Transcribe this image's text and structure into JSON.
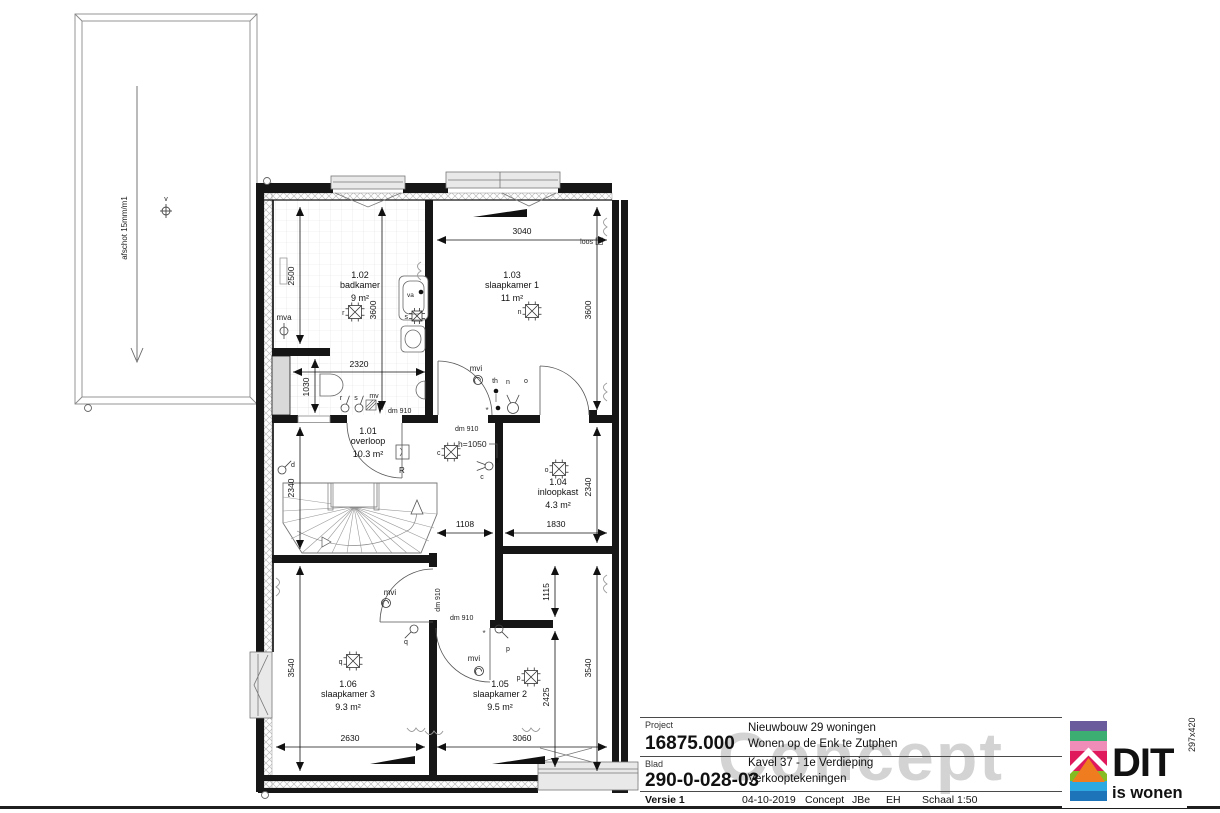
{
  "sheet": {
    "watermark": "Concept",
    "paper_size": "297x420"
  },
  "title_block": {
    "project_label": "Project",
    "project_number": "16875.000",
    "project_line1": "Nieuwbouw 29 woningen",
    "project_line2": "Wonen op de Enk te Zutphen",
    "blad_label": "Blad",
    "blad_number": "290-0-028-03",
    "blad_line1": "Kavel 37 - 1e Verdieping",
    "blad_line2": "Verkooptekeningen",
    "versie": "Versie 1",
    "date": "04-10-2019",
    "status": "Concept",
    "drawn_by": "JBe",
    "checked_by": "EH",
    "scale": "Schaal 1:50"
  },
  "logo": {
    "text_main": "DIT",
    "text_sub": "is wonen",
    "stripes": [
      "#6a5b9d",
      "#3cae71",
      "#f08cb8",
      "#e0195d",
      "#e0195d",
      "#85bc22",
      "#2ba9e0",
      "#1e74b8"
    ],
    "house_fill": "#ef7d1f"
  },
  "plan": {
    "rooms": [
      {
        "num": "1.02",
        "name": "badkamer",
        "area": "9 m²",
        "x": 360,
        "y": 278
      },
      {
        "num": "1.03",
        "name": "slaapkamer 1",
        "area": "11 m²",
        "x": 512,
        "y": 278
      },
      {
        "num": "1.01",
        "name": "overloop",
        "area": "10.3 m²",
        "x": 368,
        "y": 434
      },
      {
        "num": "1.04",
        "name": "inloopkast",
        "area": "4.3 m²",
        "x": 558,
        "y": 485
      },
      {
        "num": "1.06",
        "name": "slaapkamer 3",
        "area": "9.3 m²",
        "x": 348,
        "y": 687
      },
      {
        "num": "1.05",
        "name": "slaapkamer 2",
        "area": "9.5 m²",
        "x": 500,
        "y": 687
      }
    ],
    "dims": [
      {
        "x1": 300,
        "y1": 207,
        "x2": 300,
        "y2": 344,
        "t": "2500",
        "tx": 294,
        "ty": 276,
        "r": -90
      },
      {
        "x1": 382,
        "y1": 207,
        "x2": 382,
        "y2": 410,
        "t": "3600",
        "tx": 376,
        "ty": 310,
        "r": -90
      },
      {
        "x1": 315,
        "y1": 359,
        "x2": 315,
        "y2": 413,
        "t": "1030",
        "tx": 309,
        "ty": 387,
        "r": -90
      },
      {
        "x1": 300,
        "y1": 427,
        "x2": 300,
        "y2": 549,
        "t": "2340",
        "tx": 294,
        "ty": 488,
        "r": -90
      },
      {
        "x1": 300,
        "y1": 566,
        "x2": 300,
        "y2": 771,
        "t": "3540",
        "tx": 294,
        "ty": 668,
        "r": -90
      },
      {
        "x1": 597,
        "y1": 207,
        "x2": 597,
        "y2": 410,
        "t": "3600",
        "tx": 591,
        "ty": 310,
        "r": -90
      },
      {
        "x1": 597,
        "y1": 427,
        "x2": 597,
        "y2": 543,
        "t": "2340",
        "tx": 591,
        "ty": 487,
        "r": -90
      },
      {
        "x1": 555,
        "y1": 566,
        "x2": 555,
        "y2": 617,
        "t": "1115",
        "tx": 549,
        "ty": 592,
        "r": -90
      },
      {
        "x1": 597,
        "y1": 566,
        "x2": 597,
        "y2": 771,
        "t": "3540",
        "tx": 591,
        "ty": 668,
        "r": -90
      },
      {
        "x1": 555,
        "y1": 631,
        "x2": 555,
        "y2": 767,
        "t": "2425",
        "tx": 549,
        "ty": 697,
        "r": -90
      },
      {
        "x1": 293,
        "y1": 372,
        "x2": 425,
        "y2": 372,
        "t": "2320",
        "tx": 359,
        "ty": 367,
        "r": 0
      },
      {
        "x1": 437,
        "y1": 240,
        "x2": 607,
        "y2": 240,
        "t": "3040",
        "tx": 522,
        "ty": 234,
        "r": 0
      },
      {
        "x1": 437,
        "y1": 533,
        "x2": 493,
        "y2": 533,
        "t": "1108",
        "tx": 465,
        "ty": 527,
        "r": 0
      },
      {
        "x1": 505,
        "y1": 533,
        "x2": 607,
        "y2": 533,
        "t": "1830",
        "tx": 556,
        "ty": 527,
        "r": 0
      },
      {
        "x1": 276,
        "y1": 747,
        "x2": 425,
        "y2": 747,
        "t": "2630",
        "tx": 350,
        "ty": 741,
        "r": 0
      },
      {
        "x1": 437,
        "y1": 747,
        "x2": 607,
        "y2": 747,
        "t": "3060",
        "tx": 522,
        "ty": 741,
        "r": 0
      }
    ],
    "annots": [
      {
        "t": "mva",
        "x": 284,
        "y": 320,
        "fs": 8,
        "a": "middle"
      },
      {
        "t": "loos",
        "x": 593,
        "y": 244,
        "fs": 7,
        "a": "end"
      },
      {
        "t": "mvi",
        "x": 476,
        "y": 371,
        "fs": 8,
        "a": "middle"
      },
      {
        "t": "mvi",
        "x": 390,
        "y": 595,
        "fs": 8,
        "a": "middle"
      },
      {
        "t": "mvi",
        "x": 474,
        "y": 661,
        "fs": 8,
        "a": "middle"
      },
      {
        "t": "dm 910",
        "x": 388,
        "y": 413,
        "fs": 7,
        "a": "start"
      },
      {
        "t": "dm 910",
        "x": 455,
        "y": 431,
        "fs": 7,
        "a": "start"
      },
      {
        "t": "dm 910",
        "x": 450,
        "y": 620,
        "fs": 7,
        "a": "start"
      },
      {
        "t": "dm 910",
        "x": 440,
        "y": 600,
        "fs": 7,
        "a": "middle",
        "r": -90
      },
      {
        "t": "h=1050",
        "x": 458,
        "y": 447,
        "fs": 8.5,
        "a": "start"
      },
      {
        "t": "R",
        "x": 399,
        "y": 473,
        "fs": 8,
        "a": "start"
      },
      {
        "t": "va",
        "x": 407,
        "y": 297,
        "fs": 6.5,
        "a": "start"
      },
      {
        "t": "v",
        "x": 166,
        "y": 201,
        "fs": 7,
        "a": "middle"
      },
      {
        "t": "afschot 15mm/m1",
        "x": 127,
        "y": 228,
        "fs": 8,
        "a": "middle",
        "r": -90
      },
      {
        "t": "r",
        "x": 341,
        "y": 400,
        "fs": 7,
        "a": "middle"
      },
      {
        "t": "s",
        "x": 356,
        "y": 400,
        "fs": 7,
        "a": "middle"
      },
      {
        "t": "mv",
        "x": 374,
        "y": 398,
        "fs": 7,
        "a": "middle"
      },
      {
        "t": "th",
        "x": 495,
        "y": 383,
        "fs": 7,
        "a": "middle"
      },
      {
        "t": "n",
        "x": 508,
        "y": 384,
        "fs": 7,
        "a": "middle"
      },
      {
        "t": "o",
        "x": 526,
        "y": 383,
        "fs": 7,
        "a": "middle"
      },
      {
        "t": "d",
        "x": 293,
        "y": 467,
        "fs": 7,
        "a": "middle"
      },
      {
        "t": "q",
        "x": 406,
        "y": 644,
        "fs": 7,
        "a": "middle"
      },
      {
        "t": "p",
        "x": 508,
        "y": 651,
        "fs": 7,
        "a": "middle"
      },
      {
        "t": "c",
        "x": 482,
        "y": 479,
        "fs": 7,
        "a": "middle"
      }
    ],
    "lights": [
      {
        "x": 355,
        "y": 312,
        "l": "r"
      },
      {
        "x": 532,
        "y": 311,
        "l": "n"
      },
      {
        "x": 417,
        "y": 316,
        "l": "s",
        "s": 10
      },
      {
        "x": 451,
        "y": 452,
        "l": "c"
      },
      {
        "x": 559,
        "y": 469,
        "l": "o"
      },
      {
        "x": 353,
        "y": 661,
        "l": "q"
      },
      {
        "x": 531,
        "y": 677,
        "l": "p"
      }
    ],
    "fans": [
      {
        "x": 478,
        "y": 380
      },
      {
        "x": 386,
        "y": 603
      },
      {
        "x": 479,
        "y": 671
      }
    ],
    "switches": [
      {
        "x": 345,
        "y": 408
      },
      {
        "x": 359,
        "y": 408
      },
      {
        "x": 513,
        "y": 408,
        "r": 5.5,
        "p": [
          -115,
          -65
        ]
      },
      {
        "x": 414,
        "y": 629,
        "p": [
          135
        ]
      },
      {
        "x": 499,
        "y": 629,
        "p": [
          45
        ]
      },
      {
        "x": 282,
        "y": 470,
        "p": [
          -45
        ]
      },
      {
        "x": 489,
        "y": 466,
        "p": [
          -160,
          160
        ]
      }
    ],
    "radiators": [
      {
        "x": 607,
        "y": 218,
        "d": -1
      },
      {
        "x": 607,
        "y": 383,
        "d": -1
      },
      {
        "x": 607,
        "y": 575,
        "d": -1
      },
      {
        "x": 276,
        "y": 578,
        "d": 1
      },
      {
        "x": 421,
        "y": 262,
        "d": -1
      },
      {
        "x": 425,
        "y": 728,
        "rot": 90
      },
      {
        "x": 443,
        "y": 731,
        "rot": 90
      },
      {
        "x": 540,
        "y": 728,
        "rot": 90
      }
    ],
    "dots": [
      {
        "x": 421,
        "y": 292
      },
      {
        "x": 496,
        "y": 391
      },
      {
        "x": 498,
        "y": 408
      }
    ],
    "stars": [
      {
        "x": 487,
        "y": 413
      },
      {
        "x": 484,
        "y": 636
      }
    ]
  }
}
